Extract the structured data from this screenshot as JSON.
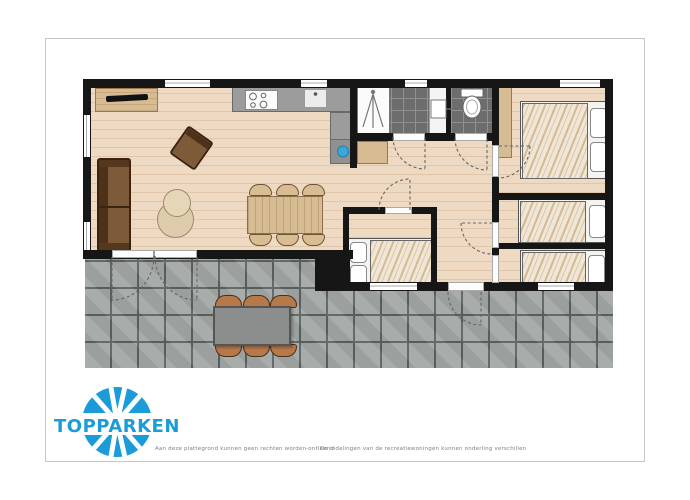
{
  "branding": {
    "logo_text": "TOPPARKEN"
  },
  "footer": {
    "disclaimer_left": "Aan deze plattegrond kunnen geen rechten worden ontleend",
    "separator": "-",
    "disclaimer_right": "De indelingen van de recreatiewoningen kunnen onderling verschillen"
  },
  "colors": {
    "wall": "#161616",
    "floor": "#eed9c3",
    "floor-line": "#e2c6aa",
    "terrace": "#a3a8a6",
    "terrace-line": "#5a6360",
    "counter": "#9c9c9c",
    "tile": "#6d6d6d",
    "wood": "#d7bb92",
    "sofa": "#7d5a38",
    "chair-outdoor": "#b5794a",
    "table-outdoor": "#8b8e8c",
    "duvet": "#f0e6d6",
    "pillow": "#ffffff",
    "blue": "#3aa7d9",
    "logo-blue": "#1b9cd8",
    "page-border": "#c6c6c6",
    "text-grey": "#808080"
  },
  "floorplan": {
    "rooms": [
      "living-room",
      "kitchen",
      "bathroom",
      "toilet",
      "hallway",
      "bedroom-double",
      "bedroom-single-middle",
      "bedroom-single-right-1",
      "bedroom-single-right-2",
      "terrace"
    ],
    "furniture": [
      "sofa",
      "armchair",
      "side-tables",
      "dining-table",
      "6-dining-chairs",
      "sideboard-tv",
      "kitchen-counter",
      "stove",
      "kitchen-sink",
      "shower",
      "washbasin",
      "toilet",
      "double-bed",
      "3-single-beds",
      "wardrobe",
      "hall-cabinet",
      "outdoor-table",
      "6-outdoor-chairs"
    ]
  }
}
